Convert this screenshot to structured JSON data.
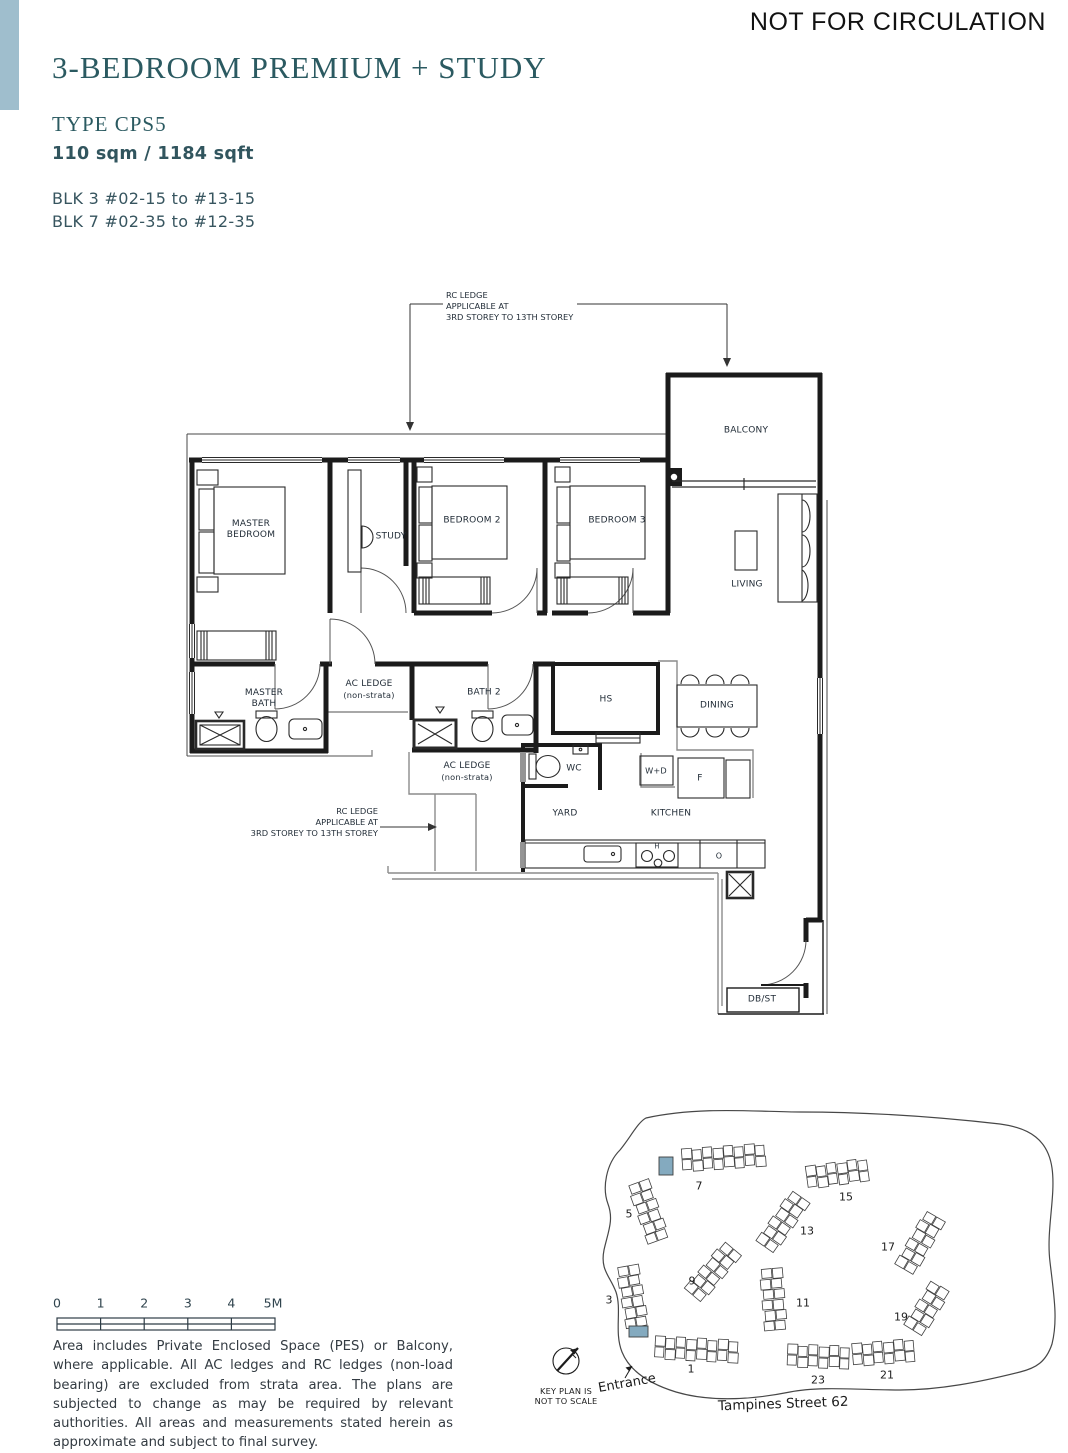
{
  "page": {
    "watermark": "NOT FOR CIRCULATION"
  },
  "header": {
    "title": "3-BEDROOM PREMIUM + STUDY",
    "type": "TYPE CPS5",
    "area": "110 sqm / 1184 sqft",
    "blk1": "BLK 3 #02-15 to #13-15",
    "blk2": "BLK 7 #02-35 to #12-35",
    "accent_color": "#9fbecd",
    "title_color": "#2b5a61"
  },
  "plan": {
    "rooms": {
      "balcony": "BALCONY",
      "master_bedroom_1": "MASTER",
      "master_bedroom_2": "BEDROOM",
      "study": "STUDY",
      "bedroom_2": "BEDROOM 2",
      "bedroom_3": "BEDROOM 3",
      "living": "LIVING",
      "master_bath_1": "MASTER",
      "master_bath_2": "BATH",
      "ac_ledge": "AC LEDGE",
      "ac_ledge_sub": "(non-strata)",
      "bath_2": "BATH 2",
      "hs": "HS",
      "dining": "DINING",
      "wc": "WC",
      "washer_dryer": "W+D",
      "fridge": "F",
      "yard": "YARD",
      "kitchen": "KITCHEN",
      "db_st": "DB/ST",
      "hob": "H",
      "oven": "O"
    },
    "rc_note_1": "RC LEDGE",
    "rc_note_2": "APPLICABLE AT",
    "rc_note_3": "3RD STOREY TO 13TH STOREY"
  },
  "scalebar": {
    "labels": [
      "0",
      "1",
      "2",
      "3",
      "4",
      "5M"
    ]
  },
  "disclaimer": "Area includes Private Enclosed Space (PES) or Balcony, where applicable. All AC ledges and RC ledges (non-load bearing) are excluded from strata area. The plans are subjected to change as may be required by relevant authorities. All areas and measurements stated herein as approximate and subject to final survey.",
  "keyplan": {
    "blocks": [
      "1",
      "3",
      "5",
      "7",
      "9",
      "11",
      "13",
      "15",
      "17",
      "19",
      "21",
      "23"
    ],
    "entrance": "Entrance",
    "street": "Tampines Street 62",
    "note_1": "KEY PLAN IS",
    "note_2": "NOT TO SCALE",
    "highlight_color": "#84aabf"
  }
}
